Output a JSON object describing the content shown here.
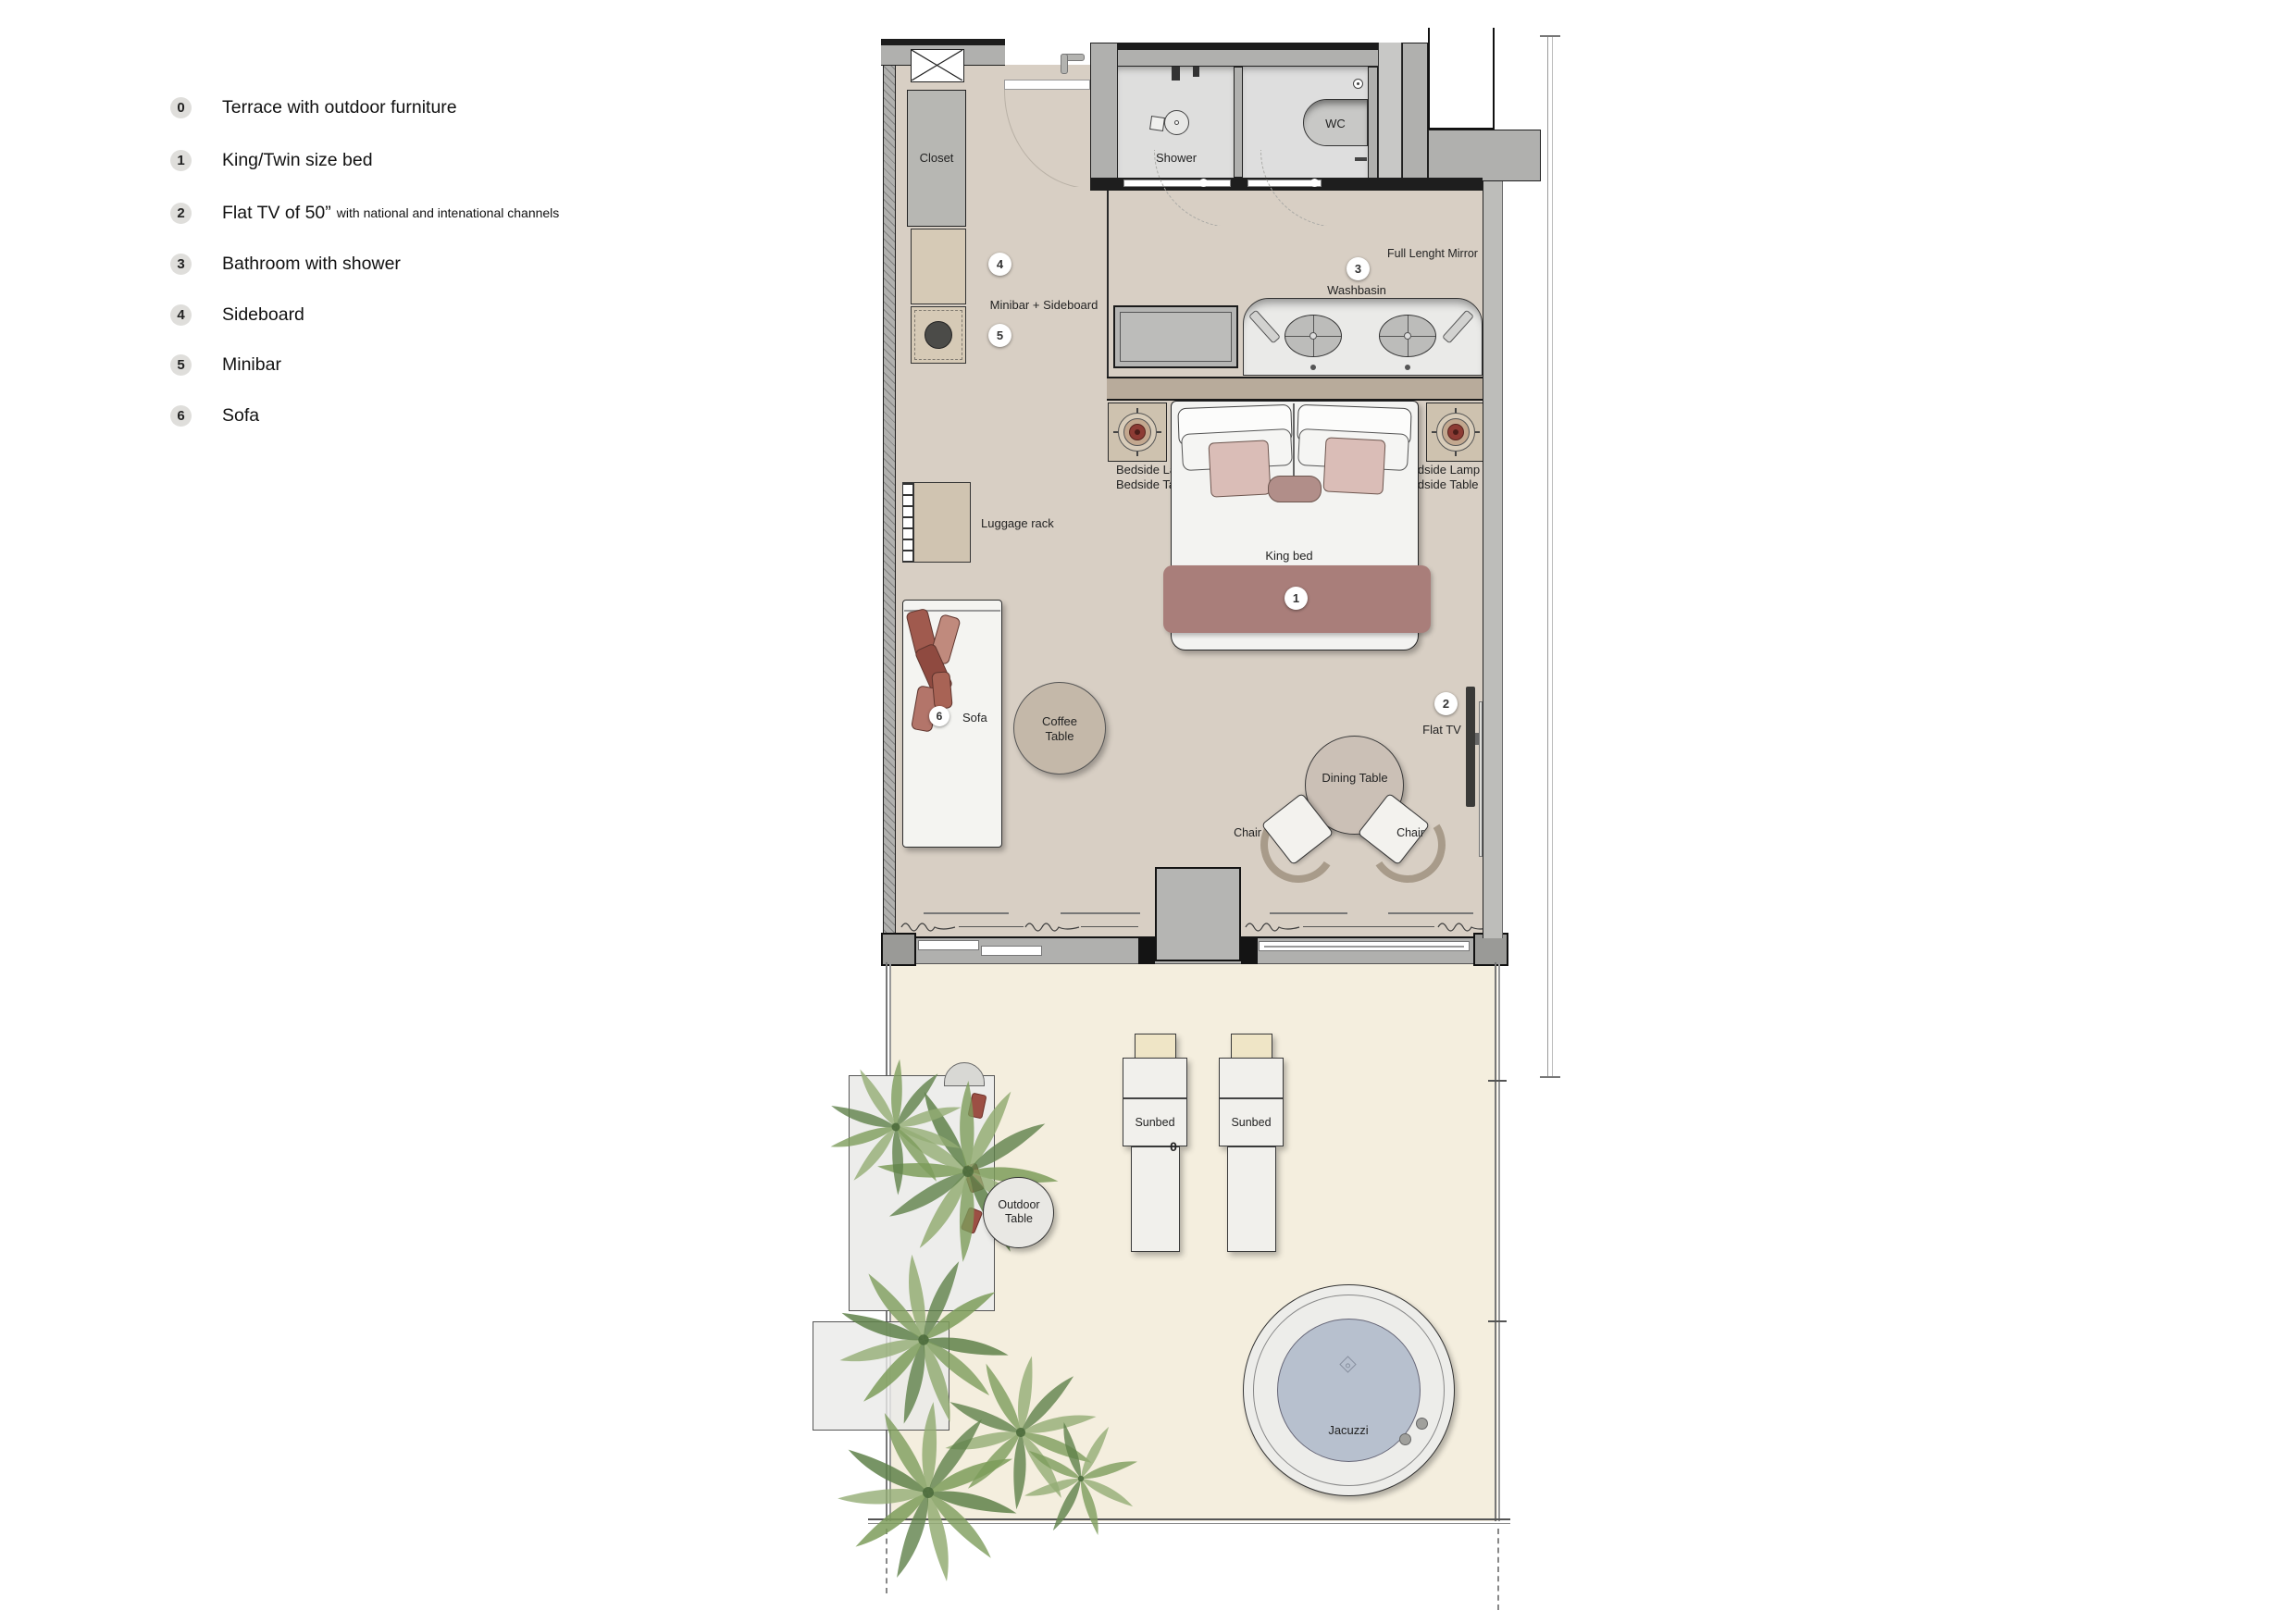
{
  "legend": {
    "items": [
      {
        "num": "0",
        "label": "Terrace with outdoor furniture",
        "sub": ""
      },
      {
        "num": "1",
        "label": "King/Twin size bed",
        "sub": ""
      },
      {
        "num": "2",
        "label": "Flat TV of 50”",
        "sub": "with national and intenational channels"
      },
      {
        "num": "3",
        "label": "Bathroom with shower",
        "sub": ""
      },
      {
        "num": "4",
        "label": "Sideboard",
        "sub": ""
      },
      {
        "num": "5",
        "label": "Minibar",
        "sub": ""
      },
      {
        "num": "6",
        "label": "Sofa",
        "sub": ""
      }
    ]
  },
  "plan": {
    "rooms": {
      "closet": "Closet",
      "shower": "Shower",
      "wc": "WC"
    },
    "labels": {
      "full_length_mirror": "Full Lenght Mirror",
      "washbasin": "Washbasin",
      "minibar_sideboard": "Minibar + Sideboard",
      "luggage_rack": "Luggage rack",
      "bedside_lamp": "Bedside Lamp",
      "bedside_table": "Bedside Table",
      "king_bed": "King bed",
      "sofa": "Sofa",
      "coffee_table": "Coffee Table",
      "dining_table": "Dining Table",
      "chair": "Chair",
      "flat_tv": "Flat TV",
      "sunbed": "Sunbed",
      "outdoor_table": "Outdoor Table",
      "jacuzzi": "Jacuzzi"
    },
    "markers": {
      "terrace": "0",
      "bed": "1",
      "tv": "2",
      "bathroom": "3",
      "sideboard": "4",
      "minibar": "5",
      "sofa": "6"
    }
  },
  "colors": {
    "room_floor": "#d8cfc4",
    "terrace_floor": "#f4eede",
    "bathroom_floor": "#dedede",
    "wall_gray": "#b0b0ae",
    "bed_runner": "#a97e7a",
    "pillow_pink": "#dabdb7",
    "lamp_red": "#8d3b34",
    "sofa_pillow": "#a05a4e",
    "palm_green": "#7d9c5b",
    "jacuzzi_water": "#b7c0ce"
  }
}
